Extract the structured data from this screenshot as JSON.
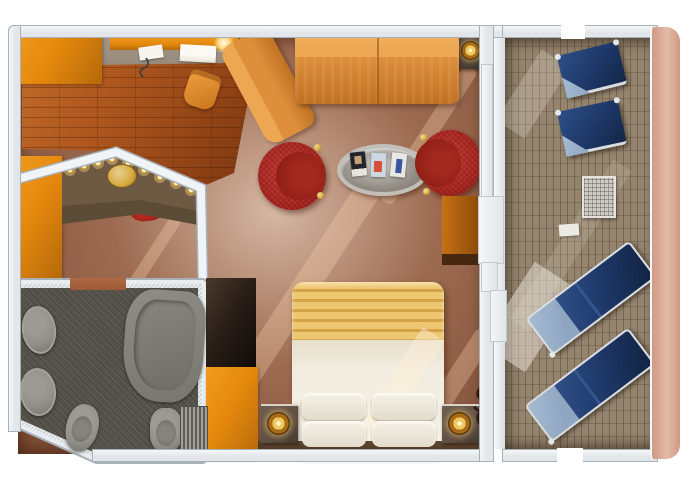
{
  "scene": {
    "kind": "cruise-suite-floorplan-render",
    "description": "Top-down 3D rendered floor plan of a ship suite with private balcony",
    "visible_text": "",
    "rooms": [
      "entry-vanity-area",
      "living-room",
      "bedroom-area",
      "bathroom",
      "balcony"
    ],
    "inventory": [
      "wardrobe-closets-orange",
      "writing-desk-with-papers-and-lamp",
      "desk-chair",
      "lighted-vanity-counter",
      "gold-stool",
      "red-stool",
      "l-shaped-sectional-sofa",
      "side-table-with-gold-lamp",
      "curtain",
      "oval-magazine-table",
      "three-magazines",
      "two-red-barrel-chairs-with-gold-finials",
      "double-bed-with-striped-blanket",
      "four-white-pillows",
      "two-nightstands-with-gold-lamps",
      "twig-decor-vase",
      "dark-wardrobe-column",
      "bathtub",
      "two-oval-sinks",
      "toilet",
      "bidet",
      "shower-mat",
      "balcony-wood-deck",
      "two-navy-deck-chairs",
      "mesh-side-table",
      "foot-pad",
      "two-navy-sun-loungers",
      "balcony-railing",
      "sliding-door-steps",
      "window-strip"
    ],
    "magazine_covers": [
      "dark cover with portrait",
      "light blue cover with red figure",
      "white cover with blue figure"
    ]
  },
  "colors": {
    "bg": "#ffffff",
    "wall": "#e2e6ea",
    "wall_edge": "#a8b0b8",
    "wall_white": "#f4f7f9",
    "carpet": "#9c6a50",
    "carpet_dark": "#7c4c36",
    "carpet_light": "#b8846294",
    "wood": "#ad561e",
    "wood_dark": "#7e3810",
    "desk_carpet": "#96887a",
    "orange": "#e5890d",
    "orange_dark": "#b5690a",
    "sofa": "#eda652",
    "sofa_mid": "#dd8f3c",
    "sofa_dark": "#c07222",
    "red": "#b5302a",
    "red_dark": "#8c1d15",
    "gold": "#d8a93c",
    "gold_light": "#fff3c9",
    "table_rim": "#c2bfb9",
    "table_glass": "#979289",
    "bed_white": "#f1ecdf",
    "pillow": "#f5f1e7",
    "blanket": "#ecc671",
    "blanket_stripe": "#d3a247",
    "stand": "#5e5043",
    "shelf": "#4e3a28",
    "bath_floor": "#56534b",
    "fixture": "#90908a",
    "fixture_dark": "#74746c",
    "deck": "#8e7f6f",
    "navy": "#1d3767",
    "navy_mid": "#2e5088",
    "navy_light": "#8fa6c2",
    "steel": "#d9dde2",
    "rail": "#cf9a85",
    "rail_light": "#e4bba8",
    "curtain": "#5c150a",
    "wardrobe_dark": "#2a1f18",
    "door_wood": "#9c5a38",
    "counter": "#6e5a42",
    "counter_dark": "#584733"
  }
}
